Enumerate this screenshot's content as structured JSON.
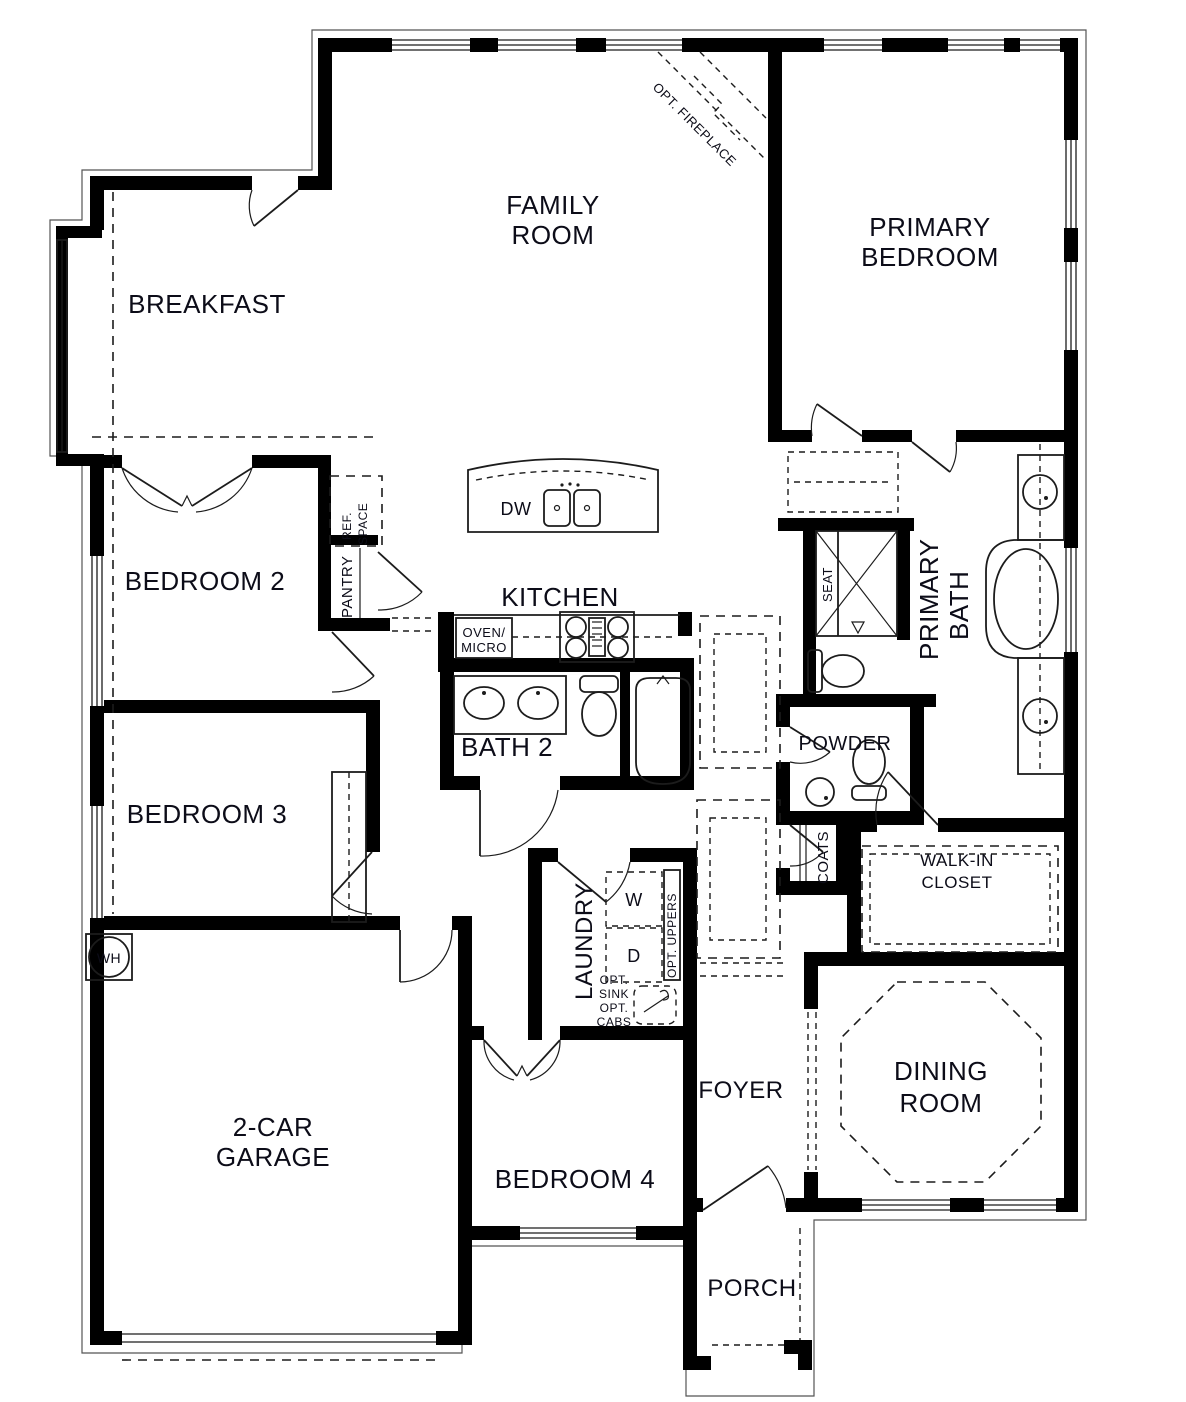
{
  "title": "Single-story floor plan",
  "colors": {
    "wall": "#000000",
    "line": "#1c1c1c",
    "text": "#0c0c18",
    "background": "#ffffff"
  },
  "rooms": {
    "family_room": {
      "line1": "FAMILY",
      "line2": "ROOM"
    },
    "primary_bedroom": {
      "line1": "PRIMARY",
      "line2": "BEDROOM"
    },
    "breakfast": {
      "label": "BREAKFAST"
    },
    "bedroom2": {
      "label": "BEDROOM 2"
    },
    "bedroom3": {
      "label": "BEDROOM 3"
    },
    "bedroom4": {
      "label": "BEDROOM 4"
    },
    "kitchen": {
      "label": "KITCHEN"
    },
    "bath2": {
      "label": "BATH 2"
    },
    "primary_bath": {
      "line1": "PRIMARY",
      "line2": "BATH"
    },
    "powder": {
      "label": "POWDER"
    },
    "walk_in_closet": {
      "line1": "WALK-IN",
      "line2": "CLOSET"
    },
    "laundry": {
      "label": "LAUNDRY"
    },
    "coats": {
      "label": "COATS"
    },
    "garage": {
      "line1": "2-CAR",
      "line2": "GARAGE"
    },
    "foyer": {
      "label": "FOYER"
    },
    "dining_room": {
      "line1": "DINING",
      "line2": "ROOM"
    },
    "porch": {
      "label": "PORCH"
    }
  },
  "features": {
    "opt_fireplace": "OPT. FIREPLACE",
    "ref_space": {
      "line1": "REF.",
      "line2": "SPACE"
    },
    "pantry": "PANTRY",
    "dw": "DW",
    "oven_micro": {
      "line1": "OVEN/",
      "line2": "MICRO"
    },
    "seat": "SEAT",
    "washer": "W",
    "dryer": "D",
    "opt_uppers": "OPT. UPPERS",
    "opt_sink": {
      "line1": "OPT.",
      "line2": "SINK",
      "line3": "OPT.",
      "line4": "CABS"
    },
    "water_heater": "WH"
  }
}
